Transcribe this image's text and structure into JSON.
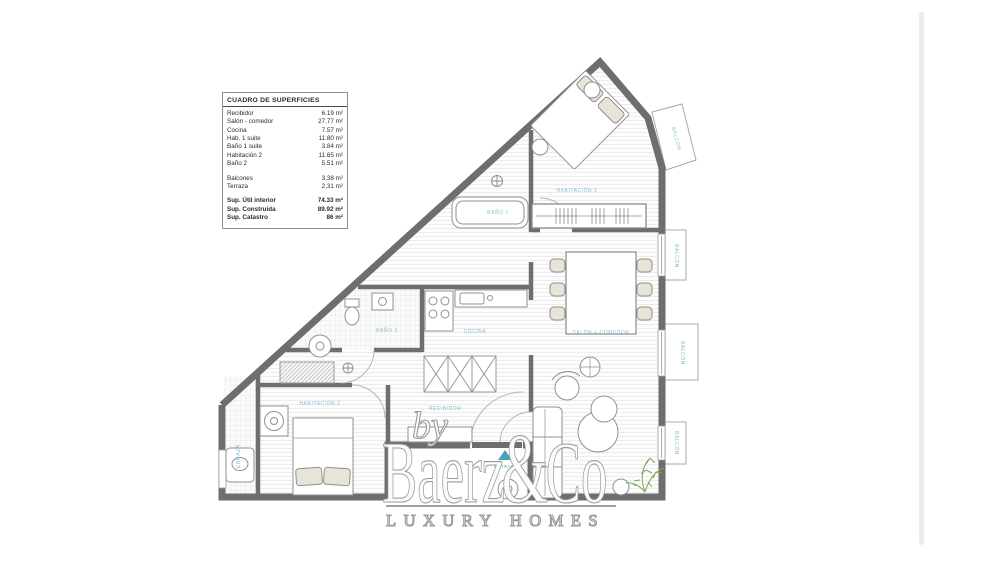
{
  "surfaces_table": {
    "title": "CUADRO DE SUPERFICIES",
    "rows": [
      {
        "label": "Recibidor",
        "value": "6.19 m²"
      },
      {
        "label": "Salón - comedor",
        "value": "27.77 m²"
      },
      {
        "label": "Cocina",
        "value": "7.57 m²"
      },
      {
        "label": "Hab. 1 suite",
        "value": "11.80 m²"
      },
      {
        "label": "Baño 1 suite",
        "value": "3.84 m²"
      },
      {
        "label": "Habitación 2",
        "value": "11.65 m²"
      },
      {
        "label": "Baño 2",
        "value": "5.51 m²"
      },
      {
        "label": "Balcones",
        "value": "3,38 m²"
      },
      {
        "label": "Terraza",
        "value": "2,31 m²"
      }
    ],
    "totals": [
      {
        "label": "Sup. Útil interior",
        "value": "74.33 m²"
      },
      {
        "label": "Sup. Construida",
        "value": "89.92 m²"
      },
      {
        "label": "Sup. Catastro",
        "value": "86 m²"
      }
    ]
  },
  "plan": {
    "labels": {
      "habitacion1": "HABITACIÓN 1",
      "bano1": "BAÑO 1",
      "bano2": "BAÑO 2",
      "cocina": "COCINA",
      "salon": "SALÓN + COMEDOR",
      "habitacion2": "HABITACIÓN 2",
      "recibidor": "RECIBIDOR",
      "terraza": "TERRAZA",
      "balcon": "BALCÓN",
      "entrada": "ENTRADA"
    },
    "colors": {
      "wall": "#6e6e6e",
      "room_label": "#86bfce",
      "entrance_arrow": "#45a5b8",
      "plant": "#7da65b"
    }
  },
  "watermark": {
    "by": "by",
    "brand": "Baerz",
    "amp": "&",
    "brand2": "Co",
    "tagline": "LUXURY HOMES"
  }
}
